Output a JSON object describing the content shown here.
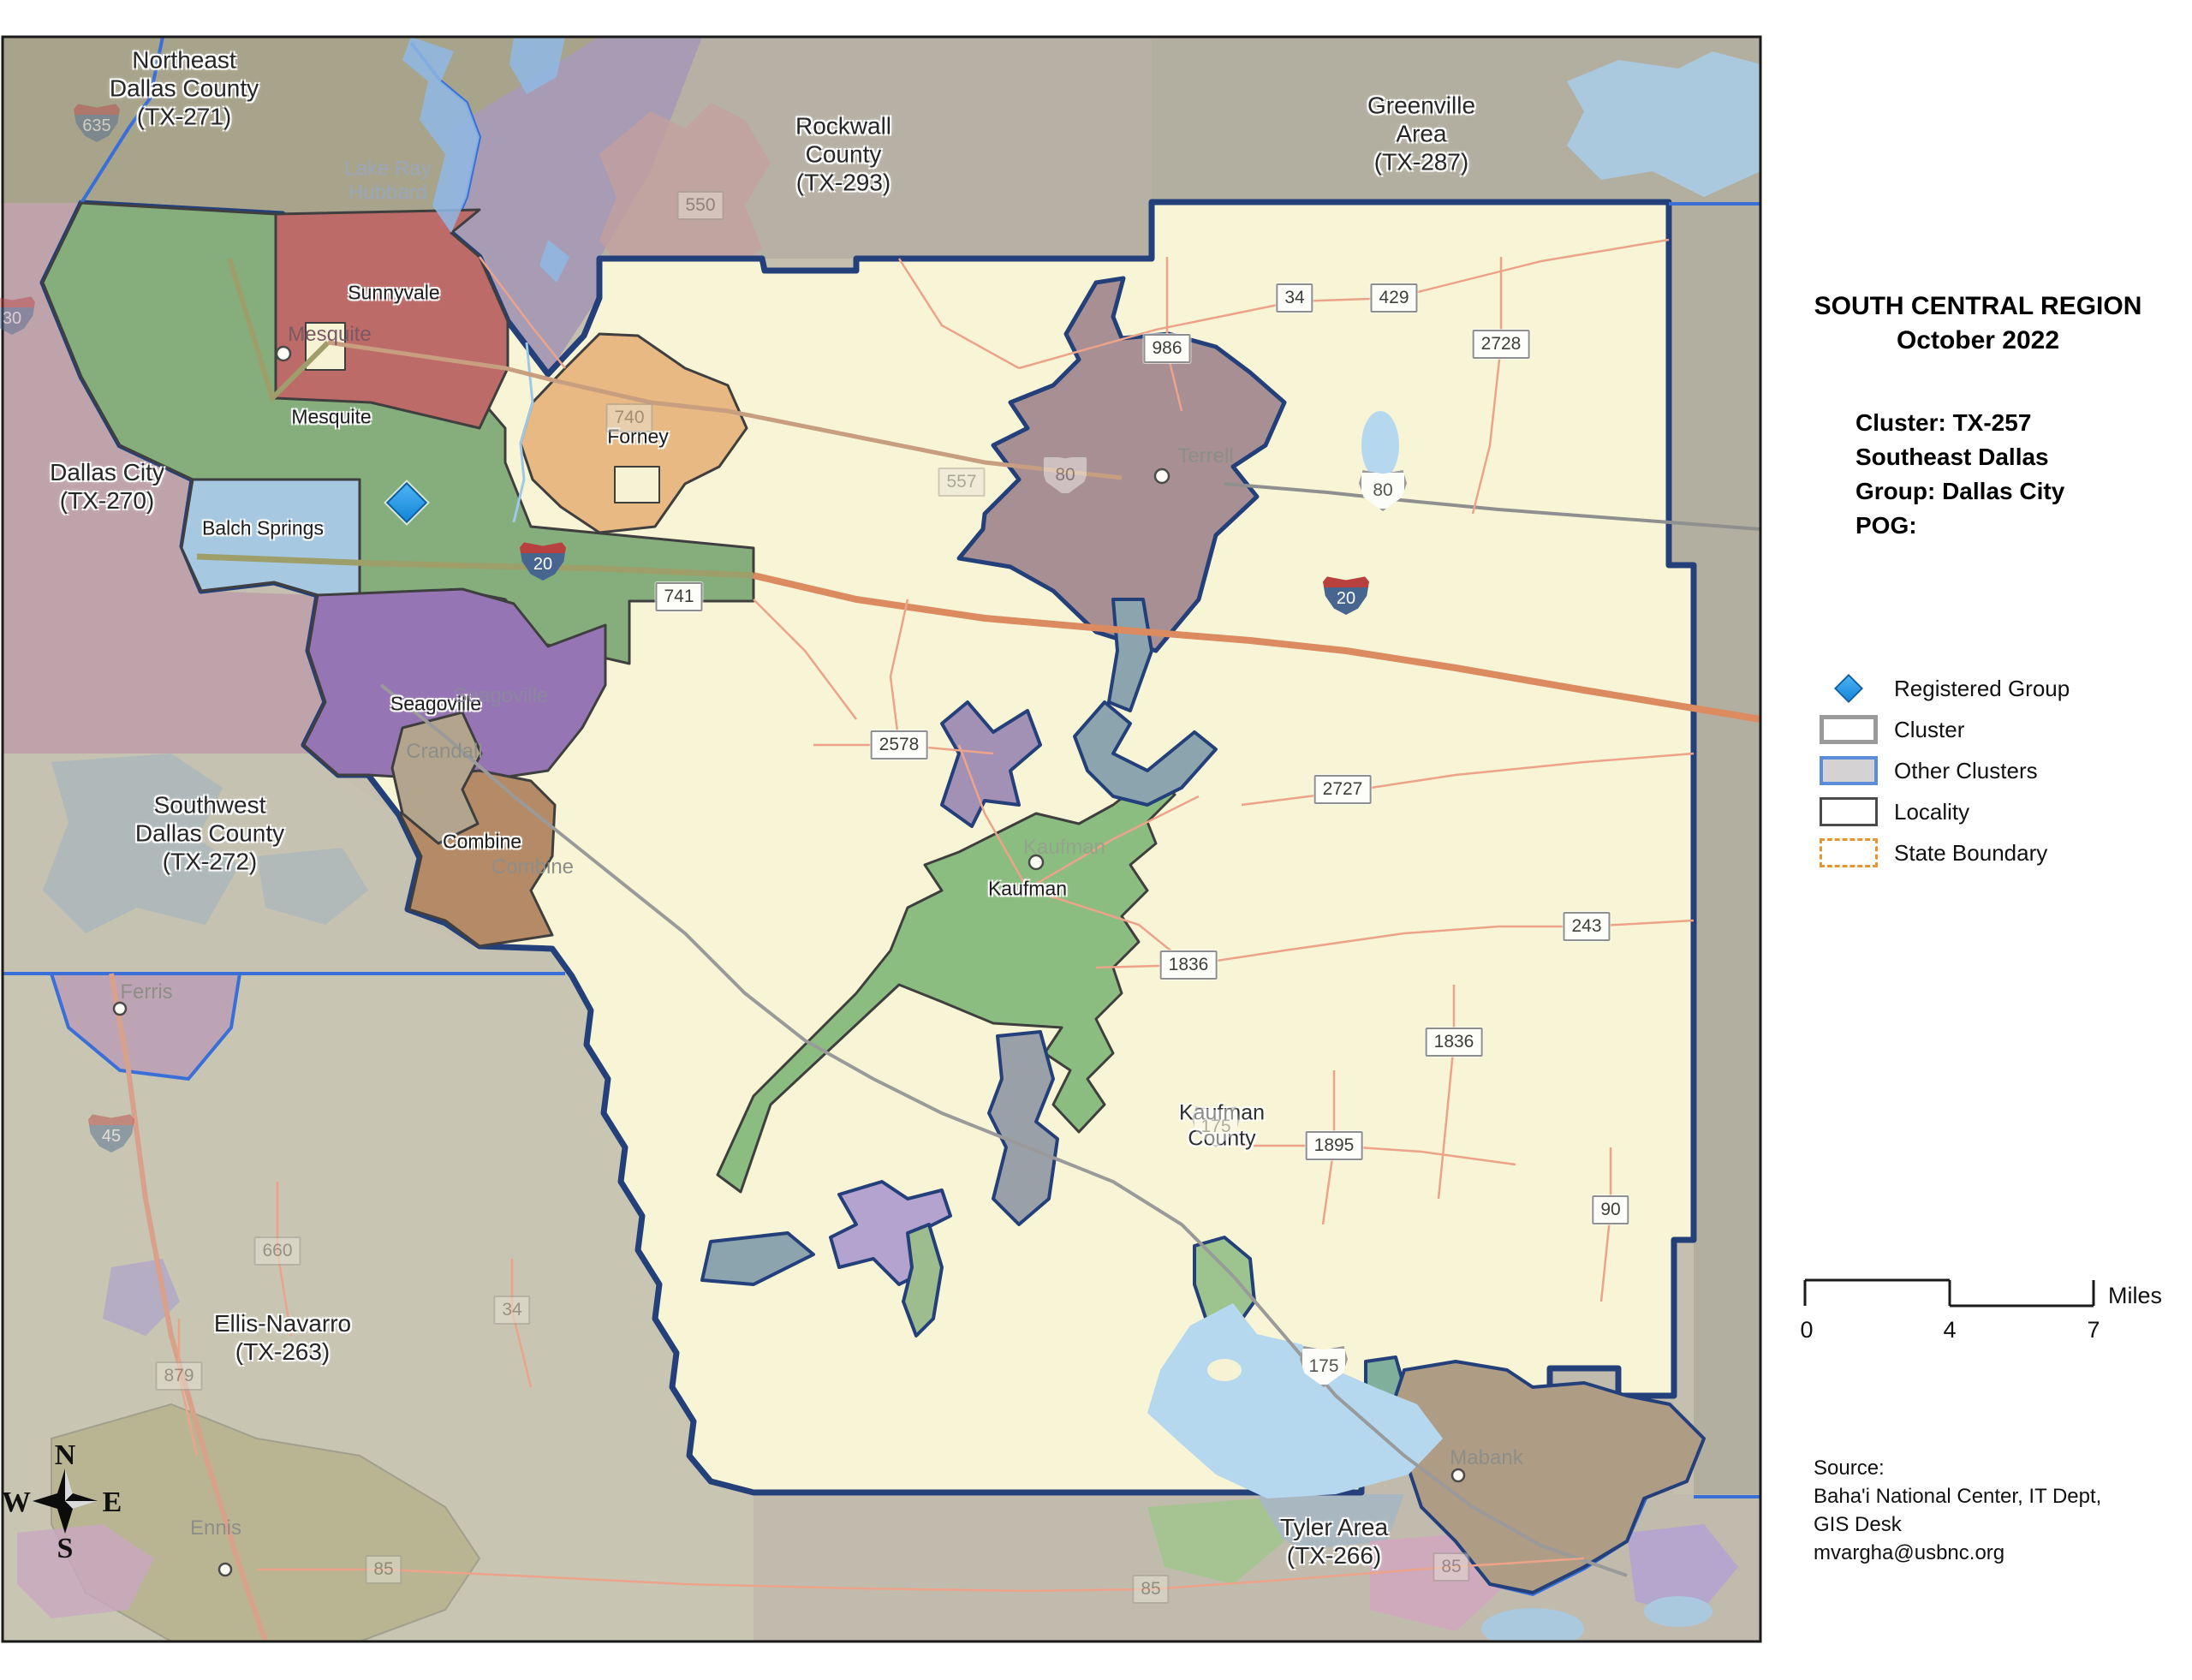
{
  "panel": {
    "title_line1": "SOUTH CENTRAL REGION",
    "title_line2": "October 2022",
    "cluster_lines": [
      "Cluster: TX-257",
      "Southeast Dallas",
      "Group: Dallas City",
      "POG:"
    ],
    "legend": {
      "registered_group": "Registered Group",
      "cluster": "Cluster",
      "other_clusters": "Other Clusters",
      "locality": "Locality",
      "state_boundary": "State Boundary"
    },
    "scale": {
      "tick0": "0",
      "tick1": "4",
      "tick2": "7",
      "unit": "Miles"
    },
    "source_lines": [
      "Source:",
      "Baha'i National Center, IT Dept,",
      "GIS Desk",
      "mvargha@usbnc.org"
    ]
  },
  "map": {
    "region_labels": [
      {
        "text": "Northeast\nDallas County\n(TX-271)"
      },
      {
        "text": "Rockwall\nCounty\n(TX-293)"
      },
      {
        "text": "Greenville\nArea\n(TX-287)"
      },
      {
        "text": "Dallas City\n(TX-270)"
      },
      {
        "text": "Southwest\nDallas County\n(TX-272)"
      },
      {
        "text": "Ellis-Navarro\n(TX-263)"
      },
      {
        "text": "Tyler Area\n(TX-266)"
      },
      {
        "text": "Kaufman\nCounty"
      }
    ],
    "city_labels": [
      "Sunnyvale",
      "Mesquite",
      "Balch Springs",
      "Seagoville",
      "Combine",
      "Forney",
      "Kaufman"
    ],
    "ghost_labels": [
      {
        "text": "Lake Ray\nHubbard"
      },
      {
        "text": "Mesquite"
      },
      {
        "text": "Seagoville"
      },
      {
        "text": "Combine"
      },
      {
        "text": "Crandall"
      },
      {
        "text": "Terrell"
      },
      {
        "text": "Kaufman"
      },
      {
        "text": "Ferris"
      },
      {
        "text": "Ennis"
      },
      {
        "text": "Mabank"
      }
    ],
    "shields_rect": [
      "34",
      "429",
      "2728",
      "986",
      "2578",
      "2727",
      "1836",
      "1836",
      "1895",
      "243",
      "90",
      "741"
    ],
    "shields_rect_ghost": [
      "550",
      "740",
      "557",
      "660",
      "879",
      "34",
      "85",
      "85",
      "85"
    ],
    "shields_us": [
      "80",
      "175"
    ],
    "shields_us_ghost": [
      "80",
      "175"
    ],
    "shields_interstate": [
      "20",
      "20"
    ],
    "shields_interstate_ghost": [
      "45",
      "635",
      "30"
    ],
    "compass": {
      "n": "N",
      "w": "W",
      "e": "E",
      "s": "S"
    }
  }
}
